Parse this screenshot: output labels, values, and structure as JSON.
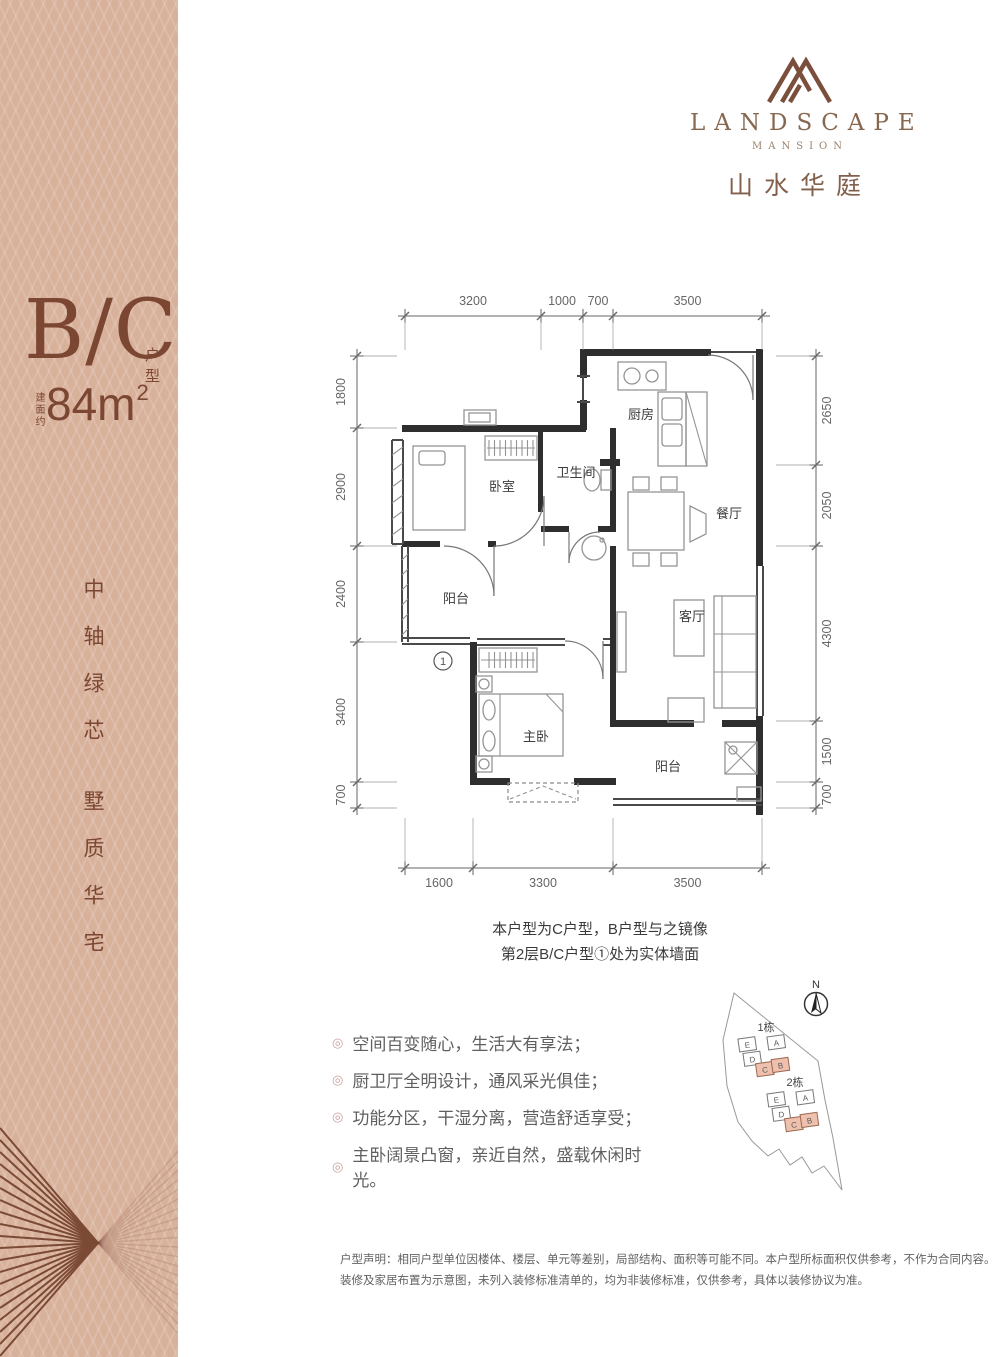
{
  "brand": {
    "logo_icon": "mountain-monogram",
    "name_en": "LANDSCAPE",
    "name_sub": "MANSION",
    "name_cn": "山水华庭"
  },
  "sidebar": {
    "unit_code": "B/C",
    "unit_code_suffix": "户型",
    "area_prefix": "建面约",
    "area_main": "84m",
    "area_exp": "2",
    "slogan_line1": "中轴绿芯",
    "slogan_line2": "墅质华宅",
    "colors": {
      "background": "#d8b19b",
      "text": "#7b4732"
    }
  },
  "floorplan": {
    "rooms": [
      {
        "id": "kitchen",
        "label": "厨房"
      },
      {
        "id": "bedroom",
        "label": "卧室"
      },
      {
        "id": "bath",
        "label": "卫生间"
      },
      {
        "id": "dining",
        "label": "餐厅"
      },
      {
        "id": "balcony_w",
        "label": "阳台"
      },
      {
        "id": "living",
        "label": "客厅"
      },
      {
        "id": "master",
        "label": "主卧"
      },
      {
        "id": "balcony_s",
        "label": "阳台"
      }
    ],
    "marker": {
      "number": "1"
    },
    "dimensions": {
      "top": [
        "3200",
        "1000",
        "700",
        "3500"
      ],
      "bottom": [
        "1600",
        "3300",
        "3500"
      ],
      "left": [
        "1800",
        "2900",
        "2400",
        "3400",
        "700"
      ],
      "right": [
        "2650",
        "2050",
        "4300",
        "1500",
        "700"
      ]
    },
    "notes": [
      "本户型为C户型，B户型与之镜像",
      "第2层B/C户型①处为实体墙面"
    ]
  },
  "features": [
    "空间百变随心，生活大有享法；",
    "厨卫厅全明设计，通风采光俱佳；",
    "功能分区，干湿分离，营造舒适享受；",
    "主卧阔景凸窗，亲近自然，盛载休闲时光。"
  ],
  "sitemap": {
    "compass_label": "N",
    "buildings": [
      {
        "name": "1栋",
        "units": [
          "E",
          "D",
          "A",
          "C",
          "B"
        ]
      },
      {
        "name": "2栋",
        "units": [
          "E",
          "D",
          "A",
          "C",
          "B"
        ]
      }
    ],
    "highlighted_units": [
      "C",
      "B"
    ],
    "highlight_color": "#eec0ad"
  },
  "disclaimer": [
    "户型声明：相同户型单位因楼体、楼层、单元等差别，局部结构、面积等可能不同。本户型所标面积仅供参考，不作为合同内容。",
    "装修及家居布置为示意图，未列入装修标准清单的，均为非装修标准，仅供参考，具体以装修协议为准。"
  ]
}
